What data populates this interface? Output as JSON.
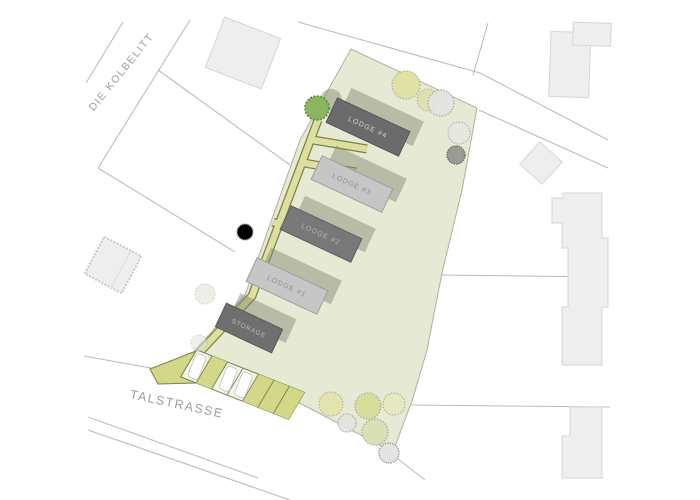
{
  "plan": {
    "type": "architectural site plan",
    "streets": {
      "kolbelitt": "DIE KOLBELITT",
      "talstrasse": "TALSTRASSE"
    },
    "lodges": {
      "lodge4": "LODGE #4",
      "lodge3": "LODGE #3",
      "lodge2": "LODGE #2",
      "lodge1": "LODGE #1",
      "storage": "STORAGE"
    },
    "parking": {
      "stall_count": 7,
      "cars_parked": 3
    },
    "colors": {
      "plot_green": "#e6e9d4",
      "plot_border": "#aeb29b",
      "path_olive_fill": "#dcdf9e",
      "path_olive_border": "#7d8148",
      "stall_olive": "#d3d788",
      "lodge_dark": "#6b6b6b",
      "lodge_medium": "#787878",
      "lodge_light": "#c6c6c6",
      "neighbor_building_gray": "#eeeeee",
      "road_line_gray": "#bdbdbd",
      "tree_green": "#8cb55f",
      "tree_pale_yellow": "#dfe2a3",
      "tree_pale_green": "#d9e0b4",
      "tree_gray": "#e4e4e2",
      "car_white": "#fdfdfd"
    }
  }
}
